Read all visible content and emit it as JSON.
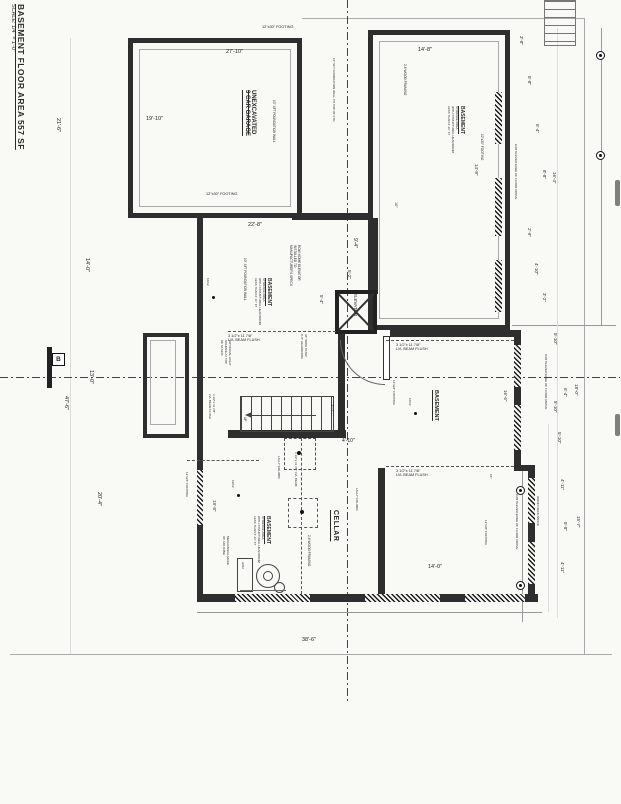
{
  "sheet": {
    "title": "BASEMENT FLOOR AREA 557 SF",
    "scale": "SCALE: 1/4\" = 1'-0\"",
    "section_marker": "B"
  },
  "rooms": {
    "garage": [
      "UNEXCAVATED",
      "3 CAR GARAGE"
    ],
    "storage_note": [
      "BASEMENT",
      "STORAGE AREA",
      "WITH STRUCTURAL HEADROOM",
      "LESS THAN 6'-11\" FT"
    ],
    "basement": "BASEMENT",
    "cellar": "CELLAR",
    "elevator": "ELEVATOR"
  },
  "notes": {
    "elevator_spec": [
      "ROW HOME ELEVATOR",
      "INSTALLED TO",
      "MANUFACTURER'S SPECS"
    ],
    "foundation_wall": "10\" SFT FOUNDATION WALL",
    "foundation_wall_ftg": "10\" SFT FOUNDATION WALL TO TOP OF FTG",
    "footing_12x30": "12\"x30\" FOOTING",
    "footing_12x24": "12\"x24\" FOOTING",
    "wood_framing": "2-6 WOOD FRAMING",
    "lvl_beam_size": "3 1/2\"x 11 7/8\"",
    "lvl_beam_flush": "LVL BEAM FLUSH",
    "lvl_beam": "3 1/2\"x 11 7/8\" LVL BEAM",
    "lally": "LALLY COLUMN",
    "cantilever": "CANTILEVER EDGE OF FLOOR ABOVE",
    "wood_deck": "WOOD DECK ABOVE",
    "stair_note": [
      "36\" WIDE STAIR",
      "6'-8\" HEADROOM"
    ],
    "light_note": [
      "ARTIFICIAL LIGHT",
      "SOURCE AT TOP",
      "OF STAIRS"
    ],
    "mech_note": [
      "MECHANICAL MAKE",
      "UP AIR ZONE"
    ],
    "up": "UP",
    "hwh": "HWH",
    "marker_10_12": "10/12",
    "ten": "10\""
  },
  "dims": {
    "left": [
      "21'-6\"",
      "14'-0\"",
      "13'-0\"",
      "47'-6\"",
      "20'-4\""
    ],
    "garage_width": "27'-10\"",
    "garage_depth": "19'-10\"",
    "mid_width": "22'-8\"",
    "tr_width": "14'-8\"",
    "tr_height": "14'-8\"",
    "bottom_width": "38'-6\"",
    "room_width": "14'-0\"",
    "room_height": "16'-6\"",
    "stair_width": "3'-2\"",
    "stair_right": "4'-10\"",
    "elev1": "9'-4\"",
    "elev2": "5'-2\"",
    "elev3": "5'-4\"",
    "cellar_left": "19'-8\"",
    "right_chain_top": [
      "3'-8\"",
      "5'-8\"",
      "6'-4\"",
      "8'-8\"",
      "16'-4\""
    ],
    "right_chain_mid": [
      "2'-9\"",
      "4'-10\"",
      "3'-2\"",
      "5'-10\"",
      "5'-10\"",
      "6'-4\"",
      "18'-0\""
    ],
    "right_chain_bottom": [
      "5'-10\"",
      "4'-11\"",
      "15'-7\"",
      "5'-8\"",
      "4'-11\""
    ]
  }
}
